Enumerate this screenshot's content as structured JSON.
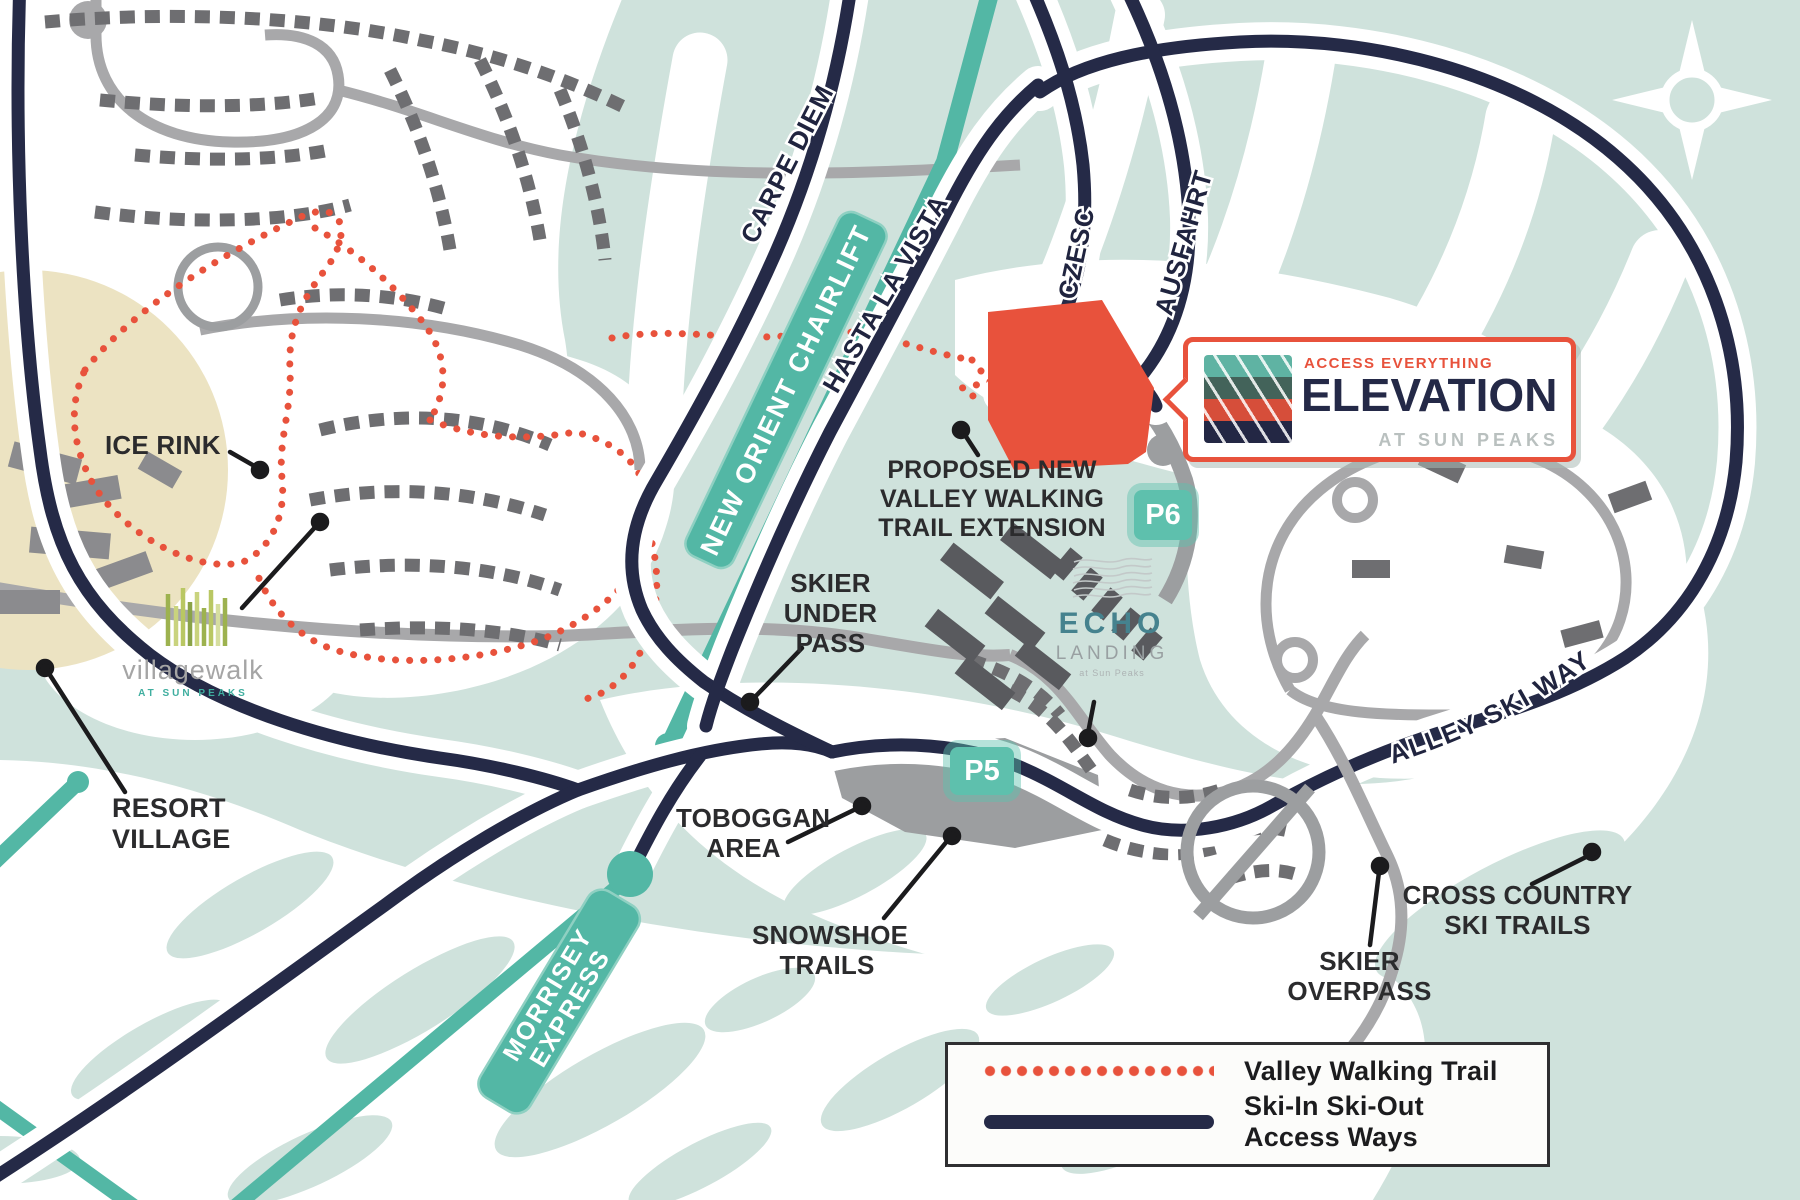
{
  "map": {
    "colors": {
      "background": "#cfe2dc",
      "ski_trail_white": "#ffffff",
      "access_way_navy": "#252a47",
      "chairlift_teal": "#53b7a5",
      "walking_trail_red": "#e8523c",
      "development_site_red": "#e8523c",
      "residential_road_gray": "#a8a8aa",
      "building_gray": "#6e6e71",
      "parking_gray": "#9c9ea0",
      "resort_village_beige": "#ece3c2",
      "parking_badge_teal": "#5ec0ad"
    },
    "place_labels": {
      "ice_rink": "ICE RINK",
      "resort_village": "RESORT VILLAGE",
      "skier_under_pass": "SKIER UNDER PASS",
      "proposed_trail": "PROPOSED NEW VALLEY WALKING TRAIL EXTENSION",
      "toboggan_area": "TOBOGGAN AREA",
      "snowshoe_trails": "SNOWSHOE TRAILS",
      "skier_overpass": "SKIER OVERPASS",
      "cross_country_ski_trails": "CROSS COUNTRY SKI TRAILS"
    },
    "road_labels": {
      "carpe_diem": "CARPE DIEM",
      "hasta_la_vista": "HASTA LA VISTA",
      "czesc": "CZESC",
      "ausfahrt": "AUSFAHRT",
      "east_valley_ski_way": "EAST VALLEY SKI WAY"
    },
    "lift_labels": {
      "new_orient": "NEW ORIENT CHAIRLIFT",
      "morrisey_line1": "MORRISEY",
      "morrisey_line2": "EXPRESS"
    },
    "parking_labels": {
      "p5": "P5",
      "p6": "P6"
    },
    "logos": {
      "elevation": {
        "tagline": "ACCESS EVERYTHING",
        "name": "ELEVATION",
        "location": "AT SUN PEAKS"
      },
      "echo_landing": {
        "name": "ECHO",
        "name2": "LANDING",
        "location": "at Sun Peaks"
      },
      "villagewalk": {
        "name": "villagewalk",
        "location": "AT SUN PEAKS"
      }
    },
    "legend": {
      "items": [
        {
          "label": "Valley Walking Trail",
          "line_style": "dotted-red"
        },
        {
          "label": "Ski-In Ski-Out Access Ways",
          "line_style": "solid-navy"
        }
      ]
    }
  }
}
